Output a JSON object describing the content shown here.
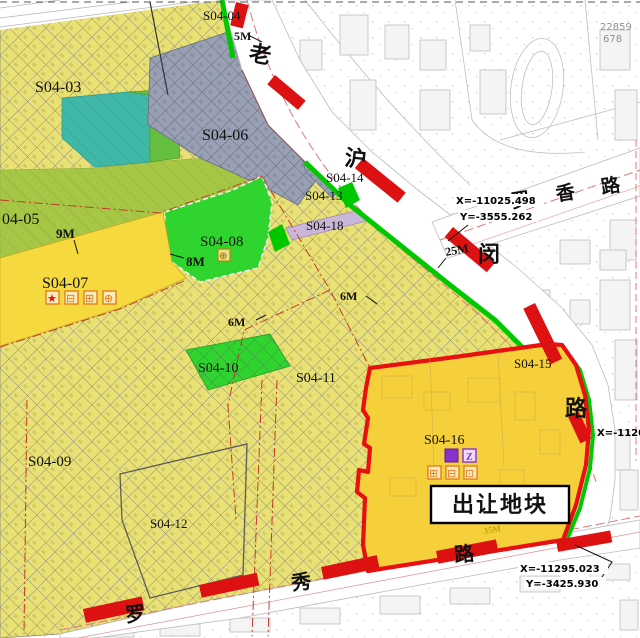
{
  "parcels": {
    "s04_03": "S04-03",
    "s04_04": "S04-04",
    "s04_05": "04-05",
    "s04_06": "S04-06",
    "s04_07": "S04-07",
    "s04_08": "S04-08",
    "s04_09": "S04-09",
    "s04_10": "S04-10",
    "s04_11": "S04-11",
    "s04_12": "S04-12",
    "s04_13": "S04-13",
    "s04_14": "S04-14",
    "s04_15": "S04-15",
    "s04_16": "S04-16",
    "s04_18": "S04-18"
  },
  "width_labels": {
    "w5": "5M",
    "w9": "9M",
    "w8": "8M",
    "w6a": "6M",
    "w6b": "6M",
    "w25": "25M",
    "w35": "35M"
  },
  "roads": {
    "lao": "老",
    "hu": "沪",
    "min": "闵",
    "lu_right": "路",
    "luoxiang": "罗 香 路",
    "luo_bottom": "罗",
    "xiu_bottom": "秀",
    "lu_bottom": "路"
  },
  "coordinates": {
    "c1x": "X=-11025.498",
    "c1y": "Y=-3555.262",
    "c2x": "X=-11295.023",
    "c2y": "Y=-3425.930",
    "c3_partial": "X=-1120"
  },
  "callout": {
    "label": "出让地块"
  },
  "corner_text": {
    "line1": "22859",
    "line2": "678"
  },
  "icons": {
    "s04_07": {
      "star": "★",
      "i1": "⊟",
      "i2": "⊞",
      "i3": "⊕"
    },
    "s04_08": {
      "i1": "⊕"
    },
    "s04_16": {
      "p1": "■",
      "p2": "Z",
      "o1": "⊞",
      "o2": "⊟",
      "o3": "⊡"
    }
  },
  "colors": {
    "hatch_yellow": "#e9e174",
    "bright_yellow": "#f6d93e",
    "transfer_fill": "#f5d03a",
    "transfer_border": "#e81010",
    "bright_green": "#2fd42f",
    "olive_green": "#a6c646",
    "teal": "#3fb8a8",
    "gray_parcel": "#99a0b3",
    "lavender": "#c9b6d9",
    "road_bar_red": "#dd1111",
    "greenbelt": "#00c800",
    "centerline_pink": "#e07878"
  }
}
